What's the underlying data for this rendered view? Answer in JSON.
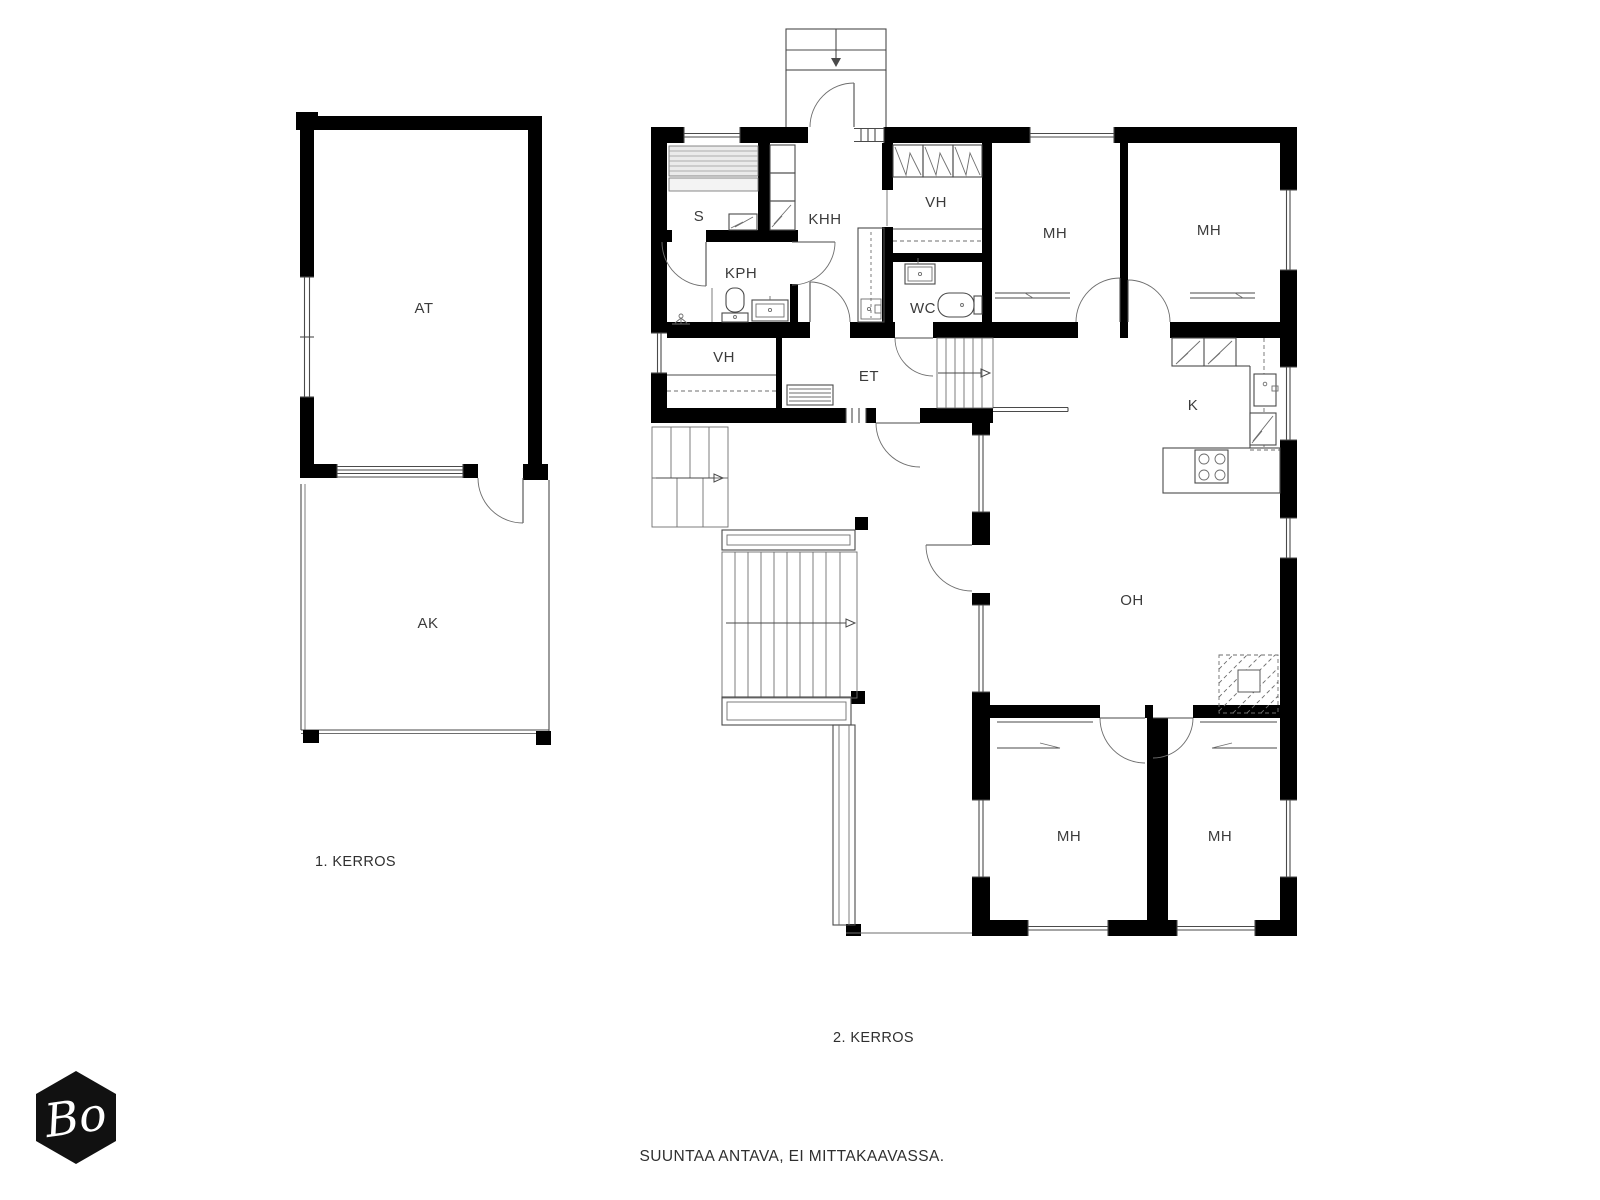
{
  "colors": {
    "wall": "#000000",
    "thin_line": "#4a4a4a",
    "label_text": "#3b3b3b",
    "sauna_bench_fill": "#ebebeb",
    "logo_background": "#111111",
    "logo_text": "#ffffff",
    "page_background": "#ffffff"
  },
  "floor1": {
    "label": "1. KERROS",
    "rooms": [
      {
        "label": "AT"
      },
      {
        "label": "AK"
      }
    ]
  },
  "floor2": {
    "label": "2. KERROS",
    "rooms": [
      {
        "label": "S"
      },
      {
        "label": "KHH"
      },
      {
        "label": "VH"
      },
      {
        "label": "MH"
      },
      {
        "label": "MH"
      },
      {
        "label": "KPH"
      },
      {
        "label": "WC"
      },
      {
        "label": "VH"
      },
      {
        "label": "ET"
      },
      {
        "label": "K"
      },
      {
        "label": "OH"
      },
      {
        "label": "MH"
      },
      {
        "label": "MH"
      }
    ]
  },
  "footer": {
    "disclaimer": "SUUNTAA ANTAVA, EI MITTAKAAVASSA."
  },
  "logo": {
    "text": "Bo"
  }
}
